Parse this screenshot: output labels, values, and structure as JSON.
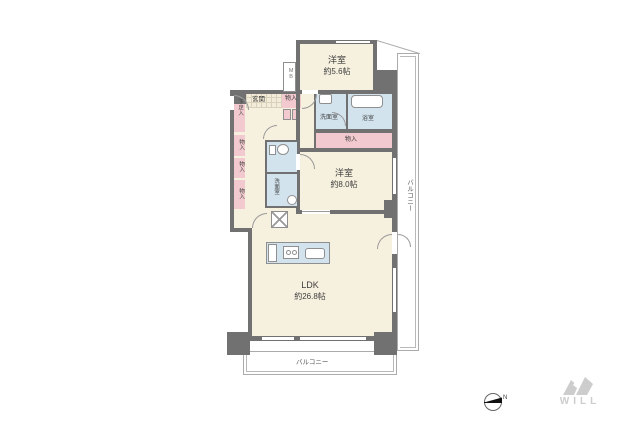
{
  "floorplan": {
    "bedroom1": {
      "name": "洋室",
      "size": "約5.6帖"
    },
    "bedroom2": {
      "name": "洋室",
      "size": "約8.0帖"
    },
    "ldk": {
      "name": "LDK",
      "size": "約26.8帖"
    },
    "washroom": {
      "name": "洗面室"
    },
    "bathroom": {
      "name": "浴室"
    },
    "powder_room": {
      "name": "洗面室"
    },
    "entrance": {
      "name": "玄関"
    },
    "shoe_box": {
      "name": "下足入"
    },
    "meter_box": {
      "name": "MB"
    },
    "closet_entrance": {
      "name": "物入"
    },
    "closet_hall": {
      "name": "物入"
    },
    "closet_left_top": {
      "name": "物入"
    },
    "closet_left_mid": {
      "name": "物入"
    },
    "closet_left_bottom": {
      "name": "物入"
    },
    "balcony_right": {
      "name": "バルコニー"
    },
    "balcony_bottom": {
      "name": "バルコニー"
    }
  },
  "compass": {
    "north_label": "N"
  },
  "branding": {
    "logo_text": "WILL"
  },
  "colors": {
    "wall": "#717171",
    "floor": "#F6F0DE",
    "closet": "#F2C9CE",
    "wet_area": "#D2E3EE",
    "balcony_line": "#ABABAB",
    "logo": "#CDCDCD"
  }
}
